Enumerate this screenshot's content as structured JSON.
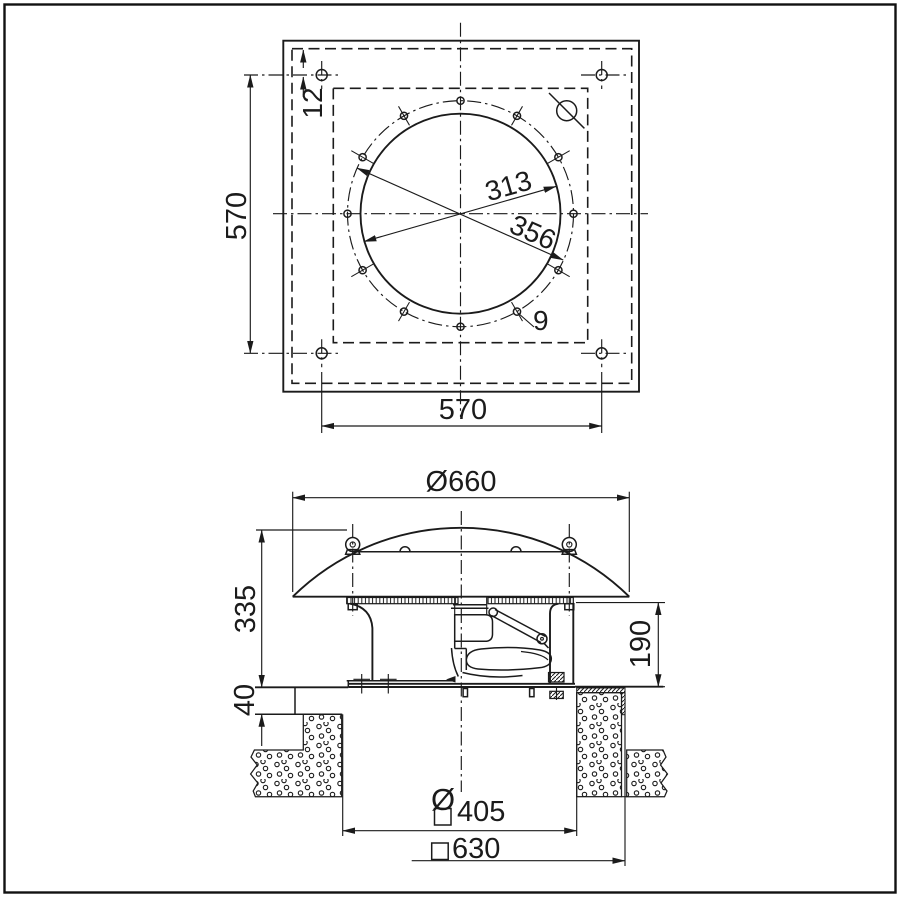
{
  "title": "Roof fan dimensional drawing",
  "colors": {
    "line": "#1b1b1b",
    "background": "#ffffff"
  },
  "top_view": {
    "hole_edge_offset": "12",
    "plate_height": "570",
    "plate_width": "570",
    "duct_diameter": "313",
    "bolt_circle_diameter": "356",
    "bolt_hole_diameter": "9"
  },
  "side_view": {
    "hood_diameter": "Ø660",
    "height_above_roof": "335",
    "housing_height": "190",
    "roof_plate_thickness": "40",
    "opening_diameter_symbol": "Ø",
    "opening_size": "405",
    "curb_outer_size": "630"
  }
}
